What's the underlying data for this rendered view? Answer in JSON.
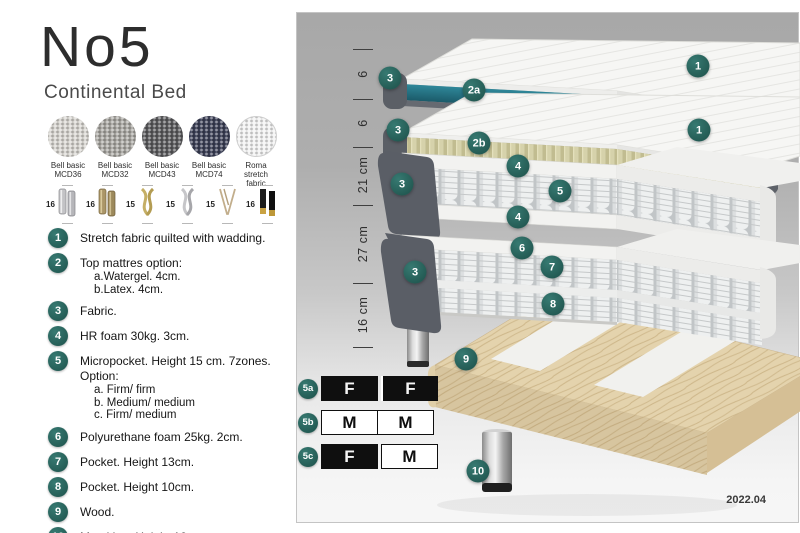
{
  "header": {
    "title": "No5",
    "subtitle": "Continental Bed"
  },
  "fabrics": [
    {
      "name_line1": "Bell basic",
      "name_line2": "MCD36",
      "color": "#d8d6d1"
    },
    {
      "name_line1": "Bell basic",
      "name_line2": "MCD32",
      "color": "#a9a7a2"
    },
    {
      "name_line1": "Bell basic",
      "name_line2": "MCD43",
      "color": "#5a5a5c"
    },
    {
      "name_line1": "Bell basic",
      "name_line2": "MCD74",
      "color": "#3a3e55"
    },
    {
      "name_line1": "Roma",
      "name_line2": "stretch fabric",
      "color": "#f3f3f3"
    }
  ],
  "legs": [
    {
      "size": "16",
      "type": "cylinder-silver"
    },
    {
      "size": "16",
      "type": "cylinder-brass"
    },
    {
      "size": "15",
      "type": "twist-gold"
    },
    {
      "size": "15",
      "type": "twist-silver"
    },
    {
      "size": "15",
      "type": "hairpin"
    },
    {
      "size": "16",
      "type": "black-gold"
    }
  ],
  "legend": {
    "items": [
      {
        "num": "1",
        "lines": [
          "Stretch fabric quilted with wadding."
        ]
      },
      {
        "num": "2",
        "lines": [
          "Top mattres option:",
          "a.Watergel. 4cm.",
          "b.Latex. 4cm."
        ]
      },
      {
        "num": "3",
        "lines": [
          "Fabric."
        ]
      },
      {
        "num": "4",
        "lines": [
          "HR foam 30kg. 3cm."
        ]
      },
      {
        "num": "5",
        "lines": [
          "Micropocket. Height 15 cm. 7zones. Option:",
          "a. Firm/ firm",
          "b. Medium/ medium",
          "c. Firm/ medium"
        ]
      },
      {
        "num": "6",
        "lines": [
          "Polyurethane foam 25kg. 2cm."
        ]
      },
      {
        "num": "7",
        "lines": [
          "Pocket. Height 13cm."
        ]
      },
      {
        "num": "8",
        "lines": [
          "Pocket. Height 10cm."
        ]
      },
      {
        "num": "9",
        "lines": [
          "Wood."
        ]
      },
      {
        "num": "10",
        "lines": [
          "Metal leg. Height 16cm."
        ]
      }
    ]
  },
  "diagram": {
    "dimensions": [
      "6",
      "6",
      "21 cm",
      "27 cm",
      "16 cm"
    ],
    "badges": [
      {
        "label": "3"
      },
      {
        "label": "2a"
      },
      {
        "label": "1"
      },
      {
        "label": "3"
      },
      {
        "label": "2b"
      },
      {
        "label": "1"
      },
      {
        "label": "4"
      },
      {
        "label": "5"
      },
      {
        "label": "4"
      },
      {
        "label": "3"
      },
      {
        "label": "6"
      },
      {
        "label": "7"
      },
      {
        "label": "3"
      },
      {
        "label": "8"
      },
      {
        "label": "9"
      },
      {
        "label": "10"
      }
    ],
    "firmness_table": {
      "rows": [
        {
          "id": "5a",
          "cells": [
            {
              "letter": "F",
              "variant": "dark"
            },
            {
              "letter": "F",
              "variant": "dark"
            }
          ]
        },
        {
          "id": "5b",
          "cells": [
            {
              "letter": "M",
              "variant": "light"
            },
            {
              "letter": "M",
              "variant": "light"
            }
          ]
        },
        {
          "id": "5c",
          "cells": [
            {
              "letter": "F",
              "variant": "dark"
            },
            {
              "letter": "M",
              "variant": "light"
            }
          ]
        }
      ]
    },
    "version": "2022.04"
  },
  "colors": {
    "badge_teal": "#2c6e67",
    "core_teal": "#26798c",
    "latex": "#d6d2ab",
    "wood": "#e4d3ad",
    "shell_gray": "#5a5e66"
  }
}
